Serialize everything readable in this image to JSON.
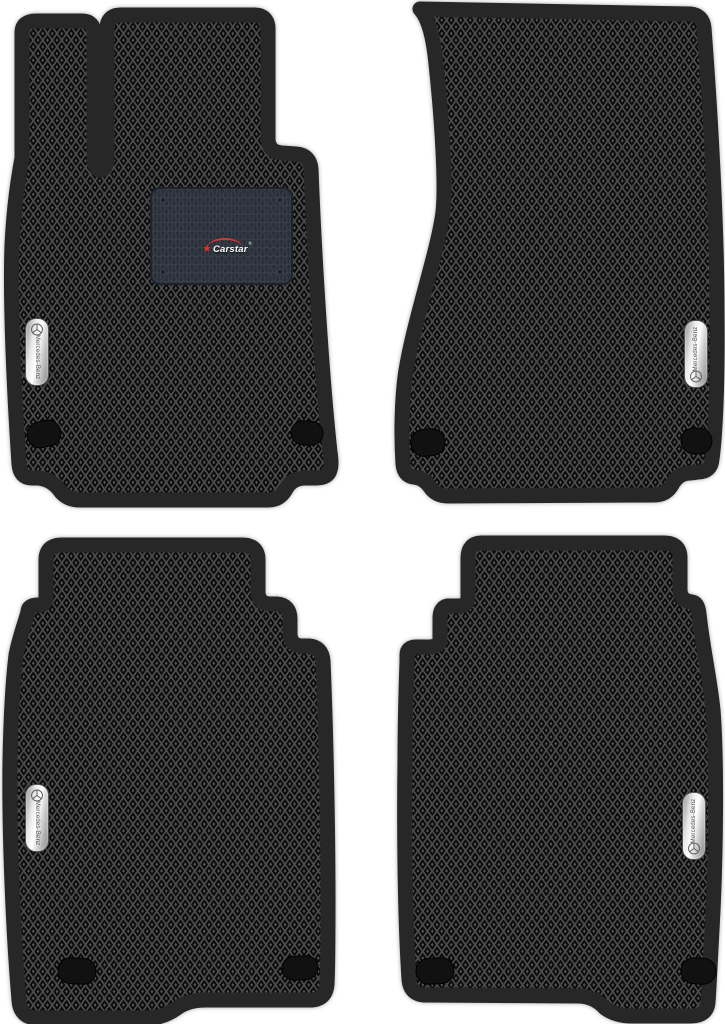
{
  "scene": {
    "background_color": "#ffffff",
    "mat_count": 4,
    "mats": [
      {
        "id": "mat-front-left",
        "badge_text": "Mercedes-Benz",
        "has_heel_pad": true,
        "fasteners": 2
      },
      {
        "id": "mat-front-right",
        "badge_text": "Mercedes-Benz",
        "has_heel_pad": false,
        "fasteners": 2
      },
      {
        "id": "mat-rear-left",
        "badge_text": "Mercedes-Benz",
        "has_heel_pad": false,
        "fasteners": 2
      },
      {
        "id": "mat-rear-right",
        "badge_text": "Mercedes-Benz",
        "has_heel_pad": false,
        "fasteners": 2
      }
    ]
  },
  "branding": {
    "heel_pad_logo": {
      "icon": "star-icon",
      "star_glyph": "★",
      "text": "Carstar",
      "registered_mark": "®",
      "accent_color": "#d7362b",
      "text_color": "#ffffff"
    },
    "oem_badge": {
      "icon": "mercedes-star-icon",
      "text": "Mercedes-Benz"
    }
  },
  "colors": {
    "background": "#ffffff",
    "mat_cell": "#0b0b0b",
    "mat_lattice": "#4d4d4d",
    "mat_dot": "#565656",
    "mat_border": "#272727",
    "heel_pad": "#2a303a",
    "heel_pad_lines": "#3c424c",
    "badge_silver": "#e8e8e8",
    "fastener": "#111111"
  }
}
